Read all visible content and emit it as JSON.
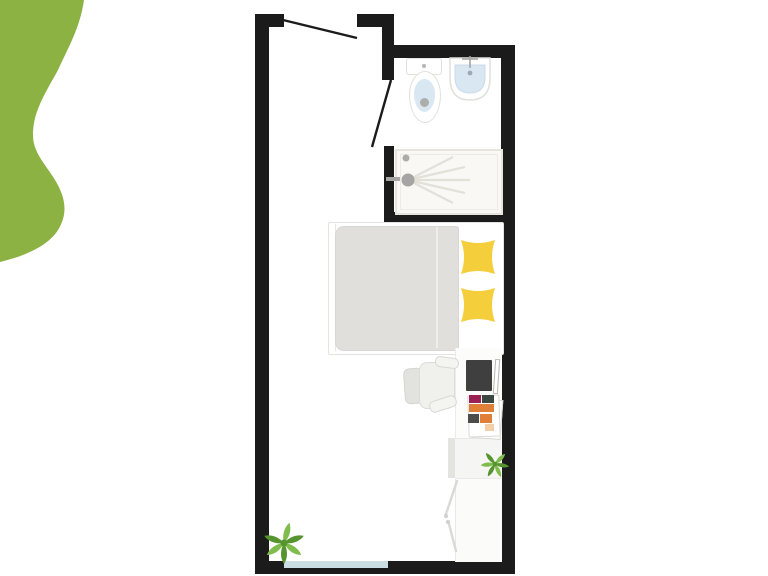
{
  "scene": {
    "type": "studio-apartment-floor-plan",
    "orientation": "top-down",
    "visible_text": "none"
  },
  "colors": {
    "background": "#FFFFFF",
    "blob": "#8CB243",
    "wall": "#1B1B1B",
    "window": "#C9DDE2",
    "pillow": "#F4CE3B",
    "duvet": "#E0DFDB",
    "shower-pan": "#FAF8F4",
    "shower-border": "#E7E4DE",
    "spray": "#E3E0DA",
    "fixture-blue": "#D9E7F3",
    "metal": "#A5A5A3",
    "chair-seat": "#F0F0ED",
    "chair-back": "#E2E2DF",
    "desk": "#FCFCFA",
    "desk-shelf": "#F5F5F3",
    "wardrobe": "#FBFBF9",
    "door-line": "#D9D9D6",
    "laptop": "#3F3F3F",
    "leaf-light": "#7FBC4C",
    "leaf-dark": "#55942F",
    "item-pink": "#9B2155",
    "item-teal": "#3C4742",
    "item-orange": "#E08038",
    "item-gray": "#4C4C4A",
    "item-peach": "#F2CFA6"
  },
  "floor_plan": {
    "areas": [
      "main-room",
      "bathroom"
    ],
    "doors": [
      "entrance-door-swing",
      "bathroom-door-swing"
    ],
    "window_count": 1,
    "furniture": [
      "toilet",
      "washbasin",
      "shower",
      "single-bed",
      "pillow-x2",
      "desk",
      "office-chair",
      "laptop",
      "stationery-papers",
      "wardrobe",
      "plant-large",
      "plant-small"
    ]
  }
}
